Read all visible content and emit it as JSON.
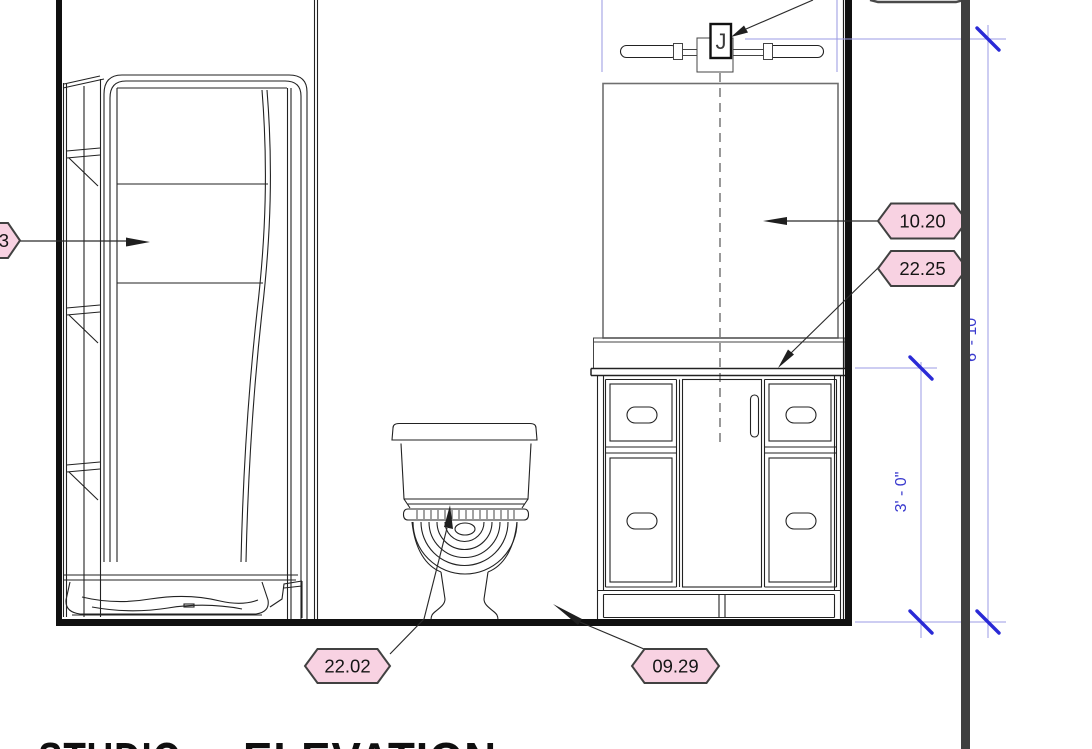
{
  "view": {
    "title_word_1": "STUDIO",
    "title_word_2": "ELEVATION"
  },
  "keynotes": [
    {
      "label": "3"
    },
    {
      "label": "10.20"
    },
    {
      "label": "22.25"
    },
    {
      "label": "22.02"
    },
    {
      "label": "09.29"
    }
  ],
  "dimensions": [
    {
      "text": "3' - 0\""
    },
    {
      "text": "6' - 10\""
    }
  ],
  "fixture": {
    "junction_box_label": "J"
  },
  "colors": {
    "tag_fill": "#f8d2e2",
    "tag_border": "#414141",
    "dim_blue_line": "#9b9be4",
    "dim_blue_tick": "#2a2ad6",
    "dim_blue_text": "#3a3ace",
    "ref_lavender": "#a9a9e6",
    "viewport_bar": "#3f3f3f",
    "linework": "#222222",
    "mirror_gray": "#6f6f6f"
  }
}
